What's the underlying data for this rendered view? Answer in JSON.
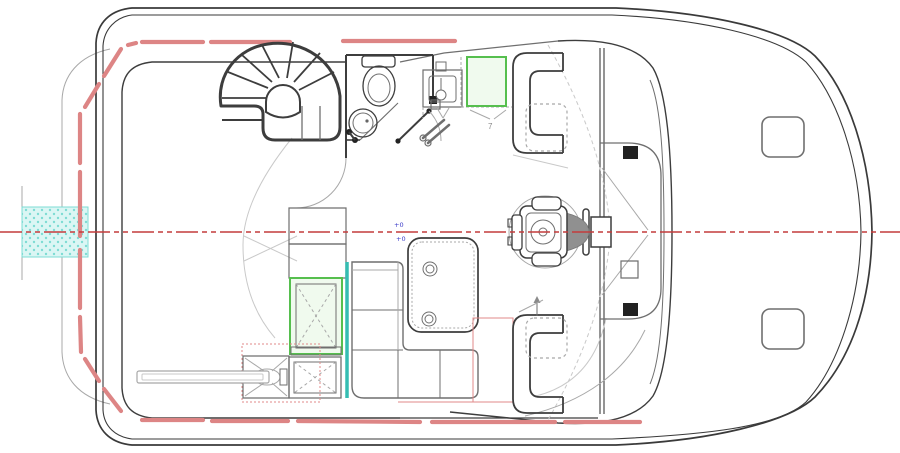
{
  "title": "Motor yacht flybridge deck plan drawing",
  "annotations": {
    "elevation_marker_1": "+0",
    "elevation_marker_2": "+0",
    "dimension_label": "7"
  },
  "colors": {
    "hull": "#3a3a3a",
    "line_mid": "#6f6f6f",
    "line_light": "#a8a8a8",
    "line_faint": "#c9c9c9",
    "track_red": "#dd8585",
    "centerline_red": "#c43c3c",
    "accent_teal": "#35bdb2",
    "accent_green": "#56bf4e",
    "green_fill": "#f0faee",
    "hatch_fill": "#dbf6f4",
    "hatch_dot": "#7edcd4",
    "dark_fill": "#222222",
    "gray_fill": "#909090",
    "marker_blue": "#3b3bc8",
    "dim_gray": "#8a8a8a"
  }
}
